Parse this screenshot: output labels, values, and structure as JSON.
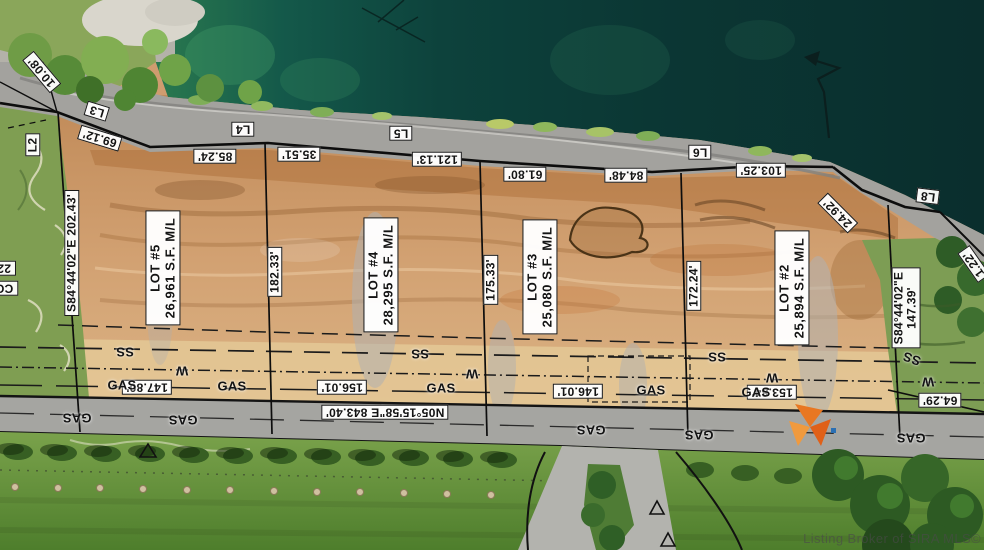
{
  "title": "plat-survey-aerial",
  "watermark": "Listing Broker of SIRA MLS©",
  "colors": {
    "label_bg": "#ffffff",
    "label_border": "#171717",
    "label_text": "#131313",
    "water_bright": "#237a52",
    "water_dark": "#0a302f",
    "riprap_gray": "#a3a29e",
    "dirt": "#cf9c6f",
    "dirt_light": "#e3c795",
    "road": "#a5a5a1",
    "grass": "#6f9a44",
    "accent_orange": "#e87722",
    "line_black": "#0d0d0d"
  },
  "lots": [
    {
      "label": "LOT #5",
      "area": "26,961 S.F. M/L"
    },
    {
      "label": "LOT #4",
      "area": "28,295 S.F. M/L"
    },
    {
      "label": "LOT #3",
      "area": "25,080 S.F. M/L"
    },
    {
      "label": "LOT #2",
      "area": "25,894 S.F. M/L"
    }
  ],
  "bearings": {
    "west_line": "S84°44'02\"E  202.43'",
    "east_line": "S84°44'02\"E  147.39'",
    "road_line": "N05°15'58\"E  843.40'"
  },
  "labels": [
    {
      "n": "curve-label-l2",
      "t": "L2",
      "x": 33,
      "y": 145,
      "r": -90,
      "c": "box"
    },
    {
      "n": "dim-10-08",
      "t": "10.08'",
      "x": 42,
      "y": 72,
      "r": 230,
      "c": "box"
    },
    {
      "n": "curve-label-l3",
      "t": "L3",
      "x": 97,
      "y": 111,
      "r": 197,
      "c": "box"
    },
    {
      "n": "dim-69-12",
      "t": "69.12'",
      "x": 100,
      "y": 138,
      "r": 197,
      "c": "box"
    },
    {
      "n": "curve-label-l4",
      "t": "L4",
      "x": 243,
      "y": 129,
      "r": 180,
      "c": "box"
    },
    {
      "n": "dim-85-24",
      "t": "85.24'",
      "x": 215,
      "y": 156,
      "r": 180,
      "c": "box"
    },
    {
      "n": "dim-35-51",
      "t": "35.51'",
      "x": 299,
      "y": 154,
      "r": 180,
      "c": "box"
    },
    {
      "n": "curve-label-l5",
      "t": "L5",
      "x": 401,
      "y": 133,
      "r": 180,
      "c": "box"
    },
    {
      "n": "dim-121-13",
      "t": "121.13'",
      "x": 437,
      "y": 159,
      "r": 180,
      "c": "box"
    },
    {
      "n": "dim-61-80",
      "t": "61.80'",
      "x": 525,
      "y": 174,
      "r": 180,
      "c": "box"
    },
    {
      "n": "dim-84-48",
      "t": "84.48'",
      "x": 626,
      "y": 175,
      "r": 180,
      "c": "box"
    },
    {
      "n": "curve-label-l6",
      "t": "L6",
      "x": 700,
      "y": 152,
      "r": 180,
      "c": "box"
    },
    {
      "n": "dim-103-25",
      "t": "103.25'",
      "x": 761,
      "y": 170,
      "r": 180,
      "c": "box"
    },
    {
      "n": "dim-24-92",
      "t": "24.92'",
      "x": 838,
      "y": 213,
      "r": 225,
      "c": "box"
    },
    {
      "n": "curve-label-l8",
      "t": "L8",
      "x": 928,
      "y": 196,
      "r": 187,
      "c": "box"
    },
    {
      "n": "dim-1-22",
      "t": "1.22'",
      "x": 974,
      "y": 264,
      "r": 235,
      "c": "box"
    },
    {
      "n": "bearing-west",
      "t": "S84°44'02\"E  202.43'",
      "x": 72,
      "y": 253,
      "r": -90,
      "c": "box"
    },
    {
      "n": "bearing-east",
      "t": "S84°44'02\"E  147.39'",
      "x": 906,
      "y": 308,
      "r": -90,
      "c": "box"
    },
    {
      "n": "edge-label-22",
      "t": "22",
      "x": 4,
      "y": 268,
      "r": 180,
      "c": "cut"
    },
    {
      "n": "edge-label-co",
      "t": "CO",
      "x": 4,
      "y": 288,
      "r": 180,
      "c": "cut"
    },
    {
      "n": "lot-5-label",
      "t": "LOT #5\n26,961 S.F. M/L",
      "x": 163,
      "y": 268,
      "r": -90,
      "c": "lot"
    },
    {
      "n": "dim-182-33",
      "t": "182.33'",
      "x": 275,
      "y": 272,
      "r": -90,
      "c": "box"
    },
    {
      "n": "lot-4-label",
      "t": "LOT #4\n28,295 S.F. M/L",
      "x": 381,
      "y": 275,
      "r": -90,
      "c": "lot"
    },
    {
      "n": "dim-175-33",
      "t": "175.33'",
      "x": 491,
      "y": 280,
      "r": -90,
      "c": "box"
    },
    {
      "n": "lot-3-label",
      "t": "LOT #3\n25,080 S.F. M/L",
      "x": 540,
      "y": 277,
      "r": -90,
      "c": "lot"
    },
    {
      "n": "dim-172-24",
      "t": "172.24'",
      "x": 694,
      "y": 286,
      "r": -90,
      "c": "box"
    },
    {
      "n": "lot-2-label",
      "t": "LOT #2\n25,894 S.F. M/L",
      "x": 792,
      "y": 288,
      "r": -90,
      "c": "lot"
    },
    {
      "n": "dim-147-80",
      "t": "147.80'",
      "x": 147,
      "y": 387,
      "r": 180,
      "c": "box"
    },
    {
      "n": "dim-156-01",
      "t": "156.01'",
      "x": 342,
      "y": 387,
      "r": 180,
      "c": "box"
    },
    {
      "n": "dim-146-01",
      "t": "146.01'",
      "x": 578,
      "y": 391,
      "r": 180,
      "c": "box"
    },
    {
      "n": "dim-153-84",
      "t": "153.84'",
      "x": 772,
      "y": 392,
      "r": 180,
      "c": "box"
    },
    {
      "n": "dim-64-29",
      "t": "64.29'",
      "x": 940,
      "y": 400,
      "r": 180,
      "c": "box"
    },
    {
      "n": "bearing-road",
      "t": "N05°15'58\"E  843.40'",
      "x": 385,
      "y": 412,
      "r": 180,
      "c": "box"
    },
    {
      "n": "gas-line-text",
      "t": "GAS",
      "x": 122,
      "y": 386,
      "r": 0,
      "c": "plain"
    },
    {
      "n": "gas-line-text",
      "t": "GAS",
      "x": 232,
      "y": 387,
      "r": 0,
      "c": "plain"
    },
    {
      "n": "gas-line-text",
      "t": "GAS",
      "x": 441,
      "y": 389,
      "r": 0,
      "c": "plain"
    },
    {
      "n": "gas-line-text",
      "t": "GAS",
      "x": 651,
      "y": 391,
      "r": 0,
      "c": "plain"
    },
    {
      "n": "gas-line-text",
      "t": "GAS",
      "x": 756,
      "y": 393,
      "r": 0,
      "c": "plain"
    },
    {
      "n": "gas-road-text",
      "t": "GAS",
      "x": 77,
      "y": 417,
      "r": 180,
      "c": "plain"
    },
    {
      "n": "gas-road-text",
      "t": "GAS",
      "x": 183,
      "y": 419,
      "r": 180,
      "c": "plain"
    },
    {
      "n": "gas-road-text",
      "t": "GAS",
      "x": 591,
      "y": 429,
      "r": 180,
      "c": "plain"
    },
    {
      "n": "gas-road-text",
      "t": "GAS",
      "x": 699,
      "y": 434,
      "r": 180,
      "c": "plain"
    },
    {
      "n": "gas-road-text",
      "t": "GAS",
      "x": 911,
      "y": 437,
      "r": 180,
      "c": "plain"
    },
    {
      "n": "ss-line-text",
      "t": "SS",
      "x": 125,
      "y": 351,
      "r": 180,
      "c": "plain"
    },
    {
      "n": "ss-line-text",
      "t": "SS",
      "x": 420,
      "y": 353,
      "r": 180,
      "c": "plain"
    },
    {
      "n": "ss-line-text",
      "t": "SS",
      "x": 717,
      "y": 356,
      "r": 180,
      "c": "plain"
    },
    {
      "n": "ss-line-text",
      "t": "SS",
      "x": 912,
      "y": 358,
      "r": 200,
      "c": "plain"
    },
    {
      "n": "water-line-text",
      "t": "W",
      "x": 182,
      "y": 370,
      "r": 180,
      "c": "plain"
    },
    {
      "n": "water-line-text",
      "t": "W",
      "x": 472,
      "y": 373,
      "r": 180,
      "c": "plain"
    },
    {
      "n": "water-line-text",
      "t": "W",
      "x": 772,
      "y": 377,
      "r": 180,
      "c": "plain"
    },
    {
      "n": "water-line-text",
      "t": "W",
      "x": 928,
      "y": 381,
      "r": 180,
      "c": "plain"
    }
  ]
}
